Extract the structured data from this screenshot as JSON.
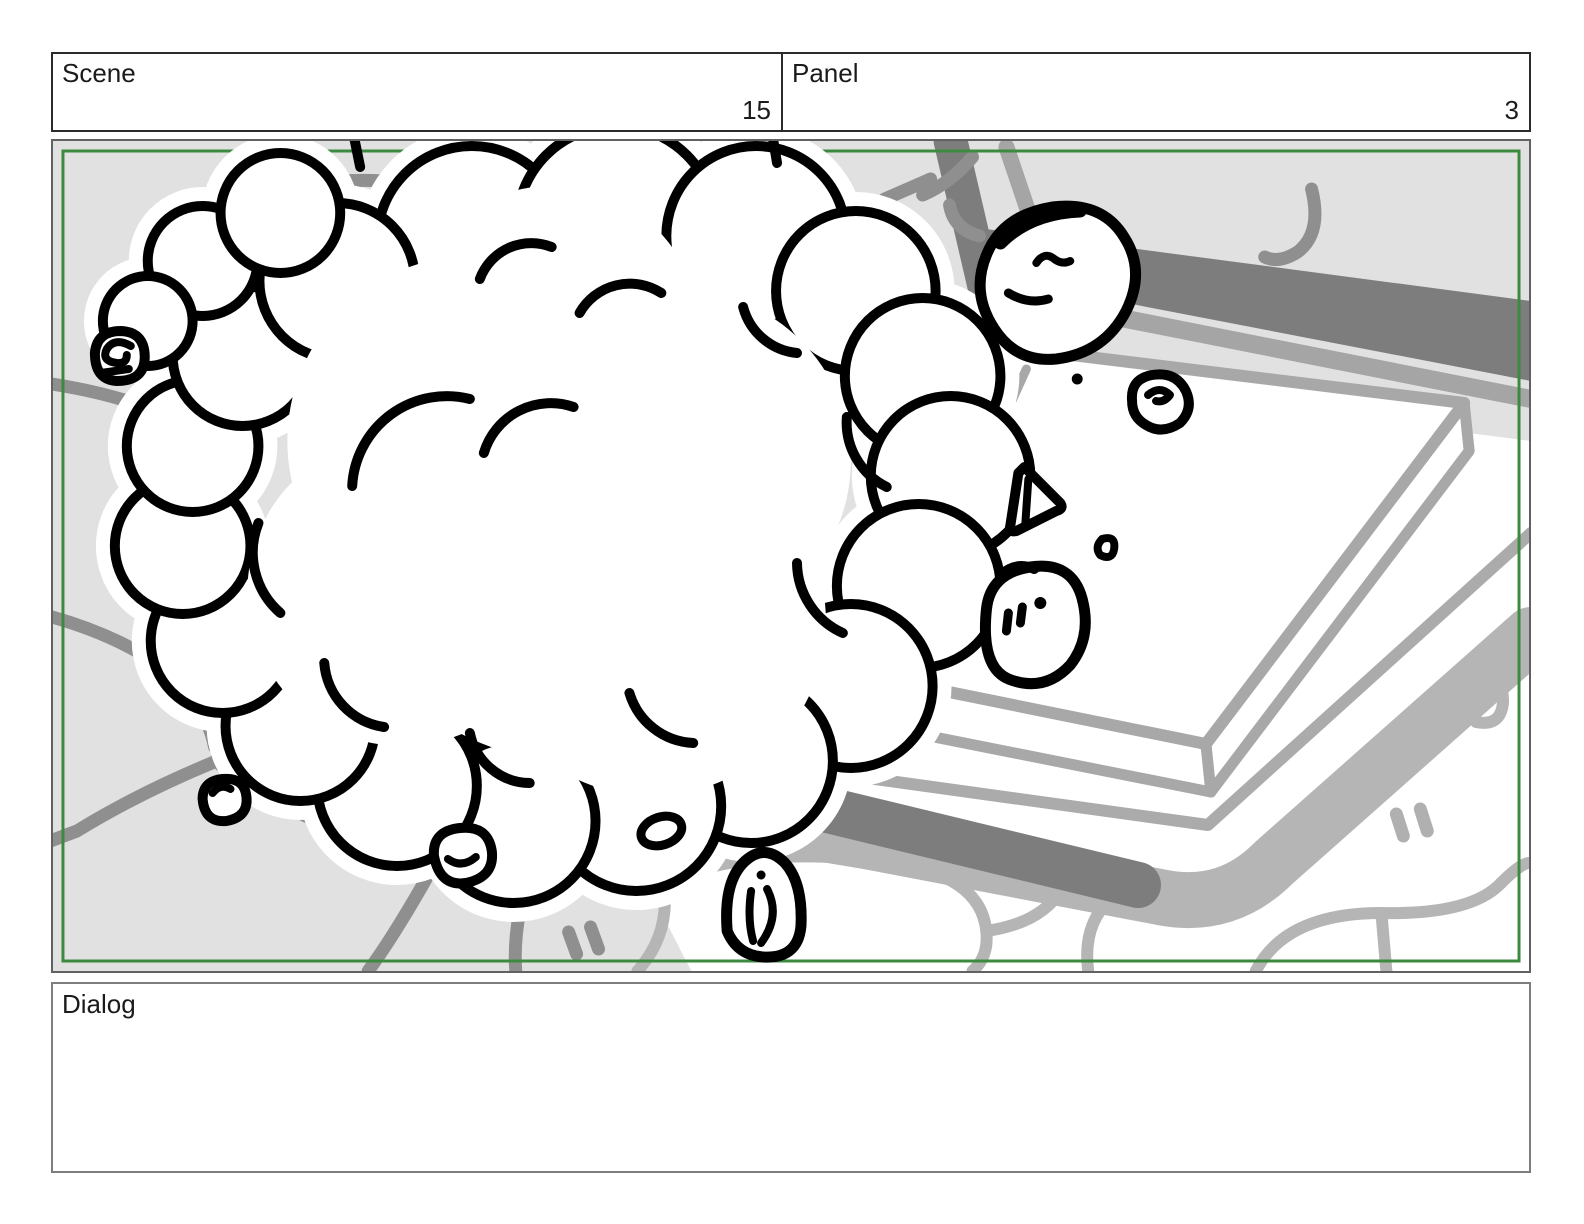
{
  "header": {
    "scene": {
      "label": "Scene",
      "value": "15"
    },
    "panel": {
      "label": "Panel",
      "value": "3"
    }
  },
  "dialog": {
    "label": "Dialog",
    "text": ""
  },
  "drawing": {
    "description": "Hand-drawn storyboard sketch: a large puffy smoke/dust cloud erupts over a cobblestone plaza; small rocks and debris fly toward a raised white stone slab platform at the right; a dark stone curb runs diagonally across the background.",
    "safe_area_border_color": "#3b8a3f",
    "colors": {
      "pavement": "#e1e1e1",
      "crack_lines": "#8f8f8f",
      "curb_dark": "#7d7d7d",
      "curb_mid": "#a5a5a5",
      "base_band": "#b5b5b5",
      "slab_outline": "#a8a8a8",
      "cobble_joints": "#b5b5b5",
      "ink": "#000000",
      "cloud_fill": "#ffffff"
    }
  }
}
